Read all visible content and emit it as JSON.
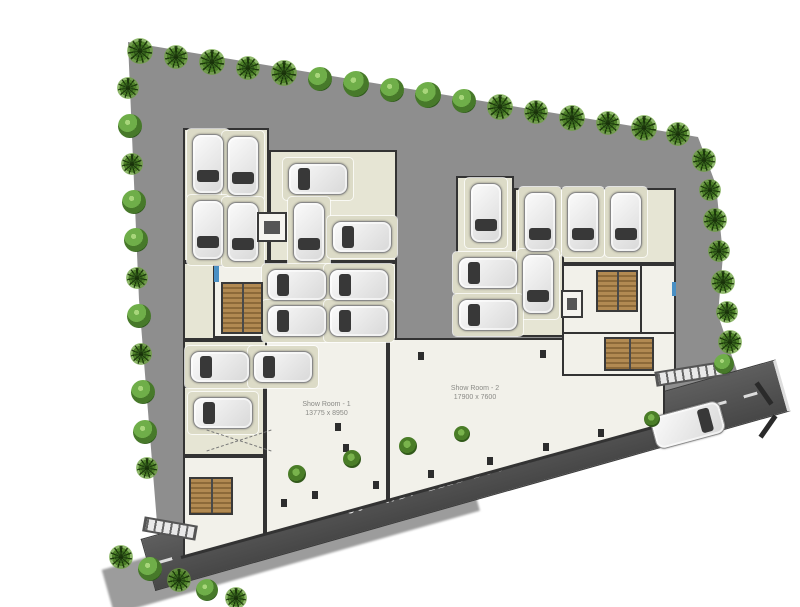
{
  "plan": {
    "type": "ground-floor site plan with parking and showrooms"
  },
  "palette": {
    "ground": "#8e8e8e",
    "floor": "#f2f1ea",
    "bay": "#e6e5d4",
    "pad": "#dcdbc7",
    "wall": "#333333",
    "road": "#4f4f4f",
    "road_line": "#dddddd",
    "stair": "#b28a52",
    "tree_dark": "#35611c",
    "tree_light": "#6fae49",
    "door": "#4a90c4"
  },
  "showrooms": [
    {
      "name": "Show Room - 1",
      "dimensions": "13775 x 8950"
    },
    {
      "name": "Show Room - 2",
      "dimensions": "17900 x 7600"
    }
  ],
  "road": {
    "label": "30'- WD. -211B BUS ROAD"
  },
  "parked_cars": [
    {
      "x": 192,
      "y": 134,
      "o": "v",
      "d": "d"
    },
    {
      "x": 227,
      "y": 136,
      "o": "v",
      "d": "d"
    },
    {
      "x": 192,
      "y": 200,
      "o": "v",
      "d": "d"
    },
    {
      "x": 227,
      "y": 202,
      "o": "v",
      "d": "d"
    },
    {
      "x": 288,
      "y": 163,
      "o": "h",
      "d": "l"
    },
    {
      "x": 293,
      "y": 202,
      "o": "v",
      "d": "d"
    },
    {
      "x": 332,
      "y": 221,
      "o": "h",
      "d": "l"
    },
    {
      "x": 267,
      "y": 269,
      "o": "h",
      "d": "l"
    },
    {
      "x": 329,
      "y": 269,
      "o": "h",
      "d": "l"
    },
    {
      "x": 267,
      "y": 305,
      "o": "h",
      "d": "l"
    },
    {
      "x": 329,
      "y": 305,
      "o": "h",
      "d": "l"
    },
    {
      "x": 190,
      "y": 351,
      "o": "h",
      "d": "l"
    },
    {
      "x": 253,
      "y": 351,
      "o": "h",
      "d": "l"
    },
    {
      "x": 193,
      "y": 397,
      "o": "h",
      "d": "l"
    },
    {
      "x": 470,
      "y": 183,
      "o": "v",
      "d": "d"
    },
    {
      "x": 524,
      "y": 192,
      "o": "v",
      "d": "d"
    },
    {
      "x": 567,
      "y": 192,
      "o": "v",
      "d": "d"
    },
    {
      "x": 610,
      "y": 192,
      "o": "v",
      "d": "d"
    },
    {
      "x": 458,
      "y": 257,
      "o": "h",
      "d": "l"
    },
    {
      "x": 522,
      "y": 254,
      "o": "v",
      "d": "d"
    },
    {
      "x": 458,
      "y": 299,
      "o": "h",
      "d": "l"
    }
  ],
  "road_car": {
    "x": 652,
    "y": 408,
    "rot": -15,
    "d": "r"
  },
  "stairs": [
    {
      "x": 221,
      "y": 282,
      "w": 42,
      "h": 52
    },
    {
      "x": 189,
      "y": 477,
      "w": 44,
      "h": 38
    },
    {
      "x": 596,
      "y": 270,
      "w": 42,
      "h": 42
    },
    {
      "x": 604,
      "y": 337,
      "w": 50,
      "h": 34
    }
  ],
  "lifts": [
    {
      "x": 257,
      "y": 212,
      "w": 30,
      "h": 30
    },
    {
      "x": 561,
      "y": 290,
      "w": 22,
      "h": 28
    }
  ],
  "doors": [
    {
      "x": 214,
      "y": 266,
      "w": 5,
      "h": 16
    },
    {
      "x": 672,
      "y": 282,
      "w": 4,
      "h": 14
    }
  ],
  "columns": [
    {
      "x": 343,
      "y": 444
    },
    {
      "x": 281,
      "y": 499
    },
    {
      "x": 312,
      "y": 491
    },
    {
      "x": 373,
      "y": 481
    },
    {
      "x": 428,
      "y": 470
    },
    {
      "x": 487,
      "y": 457
    },
    {
      "x": 543,
      "y": 443
    },
    {
      "x": 598,
      "y": 429
    },
    {
      "x": 418,
      "y": 352
    },
    {
      "x": 540,
      "y": 350
    },
    {
      "x": 335,
      "y": 423
    }
  ],
  "fences": [
    {
      "x": 143,
      "y": 521,
      "w": 54,
      "rot": 10
    },
    {
      "x": 655,
      "y": 366,
      "w": 74,
      "rot": -9
    }
  ],
  "ramp_mark": {
    "x": 205,
    "y": 420,
    "w": 68,
    "h": 40
  },
  "trees": [
    {
      "x": 140,
      "y": 51,
      "r": 13,
      "t": "palm"
    },
    {
      "x": 176,
      "y": 57,
      "r": 12,
      "t": "palm"
    },
    {
      "x": 212,
      "y": 62,
      "r": 13,
      "t": "palm"
    },
    {
      "x": 248,
      "y": 68,
      "r": 12,
      "t": "palm"
    },
    {
      "x": 284,
      "y": 73,
      "r": 13,
      "t": "palm"
    },
    {
      "x": 320,
      "y": 79,
      "r": 12,
      "t": "round"
    },
    {
      "x": 356,
      "y": 84,
      "r": 13,
      "t": "round"
    },
    {
      "x": 392,
      "y": 90,
      "r": 12,
      "t": "round"
    },
    {
      "x": 428,
      "y": 95,
      "r": 13,
      "t": "round"
    },
    {
      "x": 464,
      "y": 101,
      "r": 12,
      "t": "round"
    },
    {
      "x": 500,
      "y": 107,
      "r": 13,
      "t": "palm"
    },
    {
      "x": 536,
      "y": 112,
      "r": 12,
      "t": "palm"
    },
    {
      "x": 572,
      "y": 118,
      "r": 13,
      "t": "palm"
    },
    {
      "x": 608,
      "y": 123,
      "r": 12,
      "t": "palm"
    },
    {
      "x": 644,
      "y": 128,
      "r": 13,
      "t": "palm"
    },
    {
      "x": 678,
      "y": 134,
      "r": 12,
      "t": "palm"
    },
    {
      "x": 128,
      "y": 88,
      "r": 11,
      "t": "palm"
    },
    {
      "x": 130,
      "y": 126,
      "r": 12,
      "t": "round"
    },
    {
      "x": 132,
      "y": 164,
      "r": 11,
      "t": "palm"
    },
    {
      "x": 134,
      "y": 202,
      "r": 12,
      "t": "round"
    },
    {
      "x": 136,
      "y": 240,
      "r": 12,
      "t": "round"
    },
    {
      "x": 137,
      "y": 278,
      "r": 11,
      "t": "palm"
    },
    {
      "x": 139,
      "y": 316,
      "r": 12,
      "t": "round"
    },
    {
      "x": 141,
      "y": 354,
      "r": 11,
      "t": "palm"
    },
    {
      "x": 143,
      "y": 392,
      "r": 12,
      "t": "round"
    },
    {
      "x": 145,
      "y": 432,
      "r": 12,
      "t": "round"
    },
    {
      "x": 147,
      "y": 468,
      "r": 11,
      "t": "palm"
    },
    {
      "x": 704,
      "y": 160,
      "r": 12,
      "t": "palm"
    },
    {
      "x": 710,
      "y": 190,
      "r": 11,
      "t": "palm"
    },
    {
      "x": 715,
      "y": 220,
      "r": 12,
      "t": "palm"
    },
    {
      "x": 719,
      "y": 251,
      "r": 11,
      "t": "palm"
    },
    {
      "x": 723,
      "y": 282,
      "r": 12,
      "t": "palm"
    },
    {
      "x": 727,
      "y": 312,
      "r": 11,
      "t": "palm"
    },
    {
      "x": 730,
      "y": 342,
      "r": 12,
      "t": "palm"
    },
    {
      "x": 724,
      "y": 364,
      "r": 10,
      "t": "round"
    },
    {
      "x": 121,
      "y": 557,
      "r": 12,
      "t": "palm"
    },
    {
      "x": 150,
      "y": 569,
      "r": 12,
      "t": "round"
    },
    {
      "x": 179,
      "y": 580,
      "r": 12,
      "t": "palm"
    },
    {
      "x": 207,
      "y": 590,
      "r": 11,
      "t": "round"
    },
    {
      "x": 236,
      "y": 598,
      "r": 11,
      "t": "palm"
    },
    {
      "x": 297,
      "y": 474,
      "r": 9,
      "t": "bush"
    },
    {
      "x": 352,
      "y": 459,
      "r": 9,
      "t": "bush"
    },
    {
      "x": 408,
      "y": 446,
      "r": 9,
      "t": "bush"
    },
    {
      "x": 462,
      "y": 434,
      "r": 8,
      "t": "bush"
    },
    {
      "x": 652,
      "y": 419,
      "r": 8,
      "t": "bush"
    }
  ]
}
